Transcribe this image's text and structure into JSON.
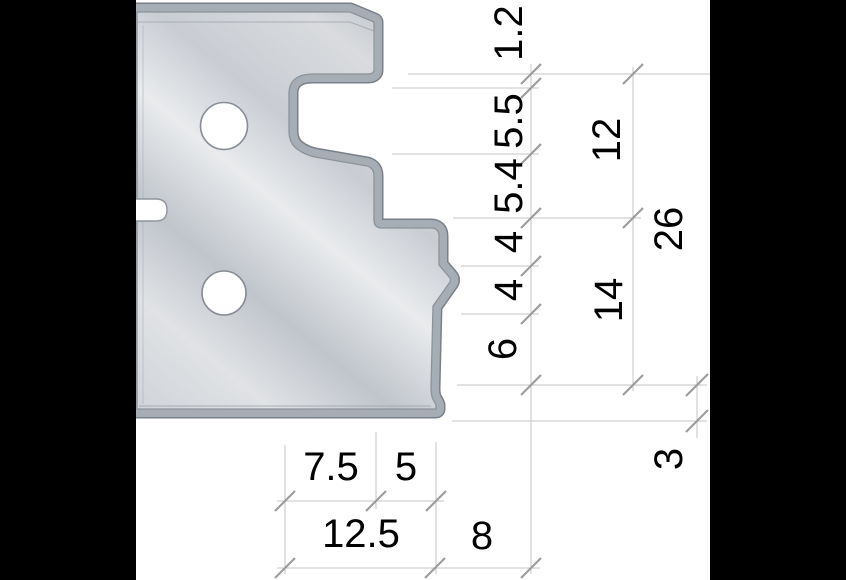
{
  "drawing": {
    "description": "cross-section profile drawing of a cutter knife with dimension chains",
    "side_dims": [
      {
        "label": "1.2"
      },
      {
        "label": "5.5"
      },
      {
        "label": "5.4"
      },
      {
        "label": "4"
      },
      {
        "label": "4"
      },
      {
        "label": "6"
      }
    ],
    "group_dims": [
      {
        "label": "12"
      },
      {
        "label": "14"
      }
    ],
    "overall_dim": {
      "label": "26"
    },
    "offset_dim": {
      "label": "3"
    },
    "bottom_row1_dims": [
      {
        "label": "7.5"
      },
      {
        "label": "5"
      }
    ],
    "bottom_row2_dims": [
      {
        "label": "12.5"
      },
      {
        "label": "8"
      }
    ],
    "colors": {
      "background": "#ffffff",
      "pillarbox": "#000000",
      "steel_light": "#e8eaec",
      "steel_mid": "#c0c5cb",
      "edge_band": "#a7adb5",
      "edge_outline": "#7a8089",
      "dimension_line": "#c6c6c6",
      "tick_mark": "#9e9e9e",
      "label_text": "#000000"
    }
  }
}
